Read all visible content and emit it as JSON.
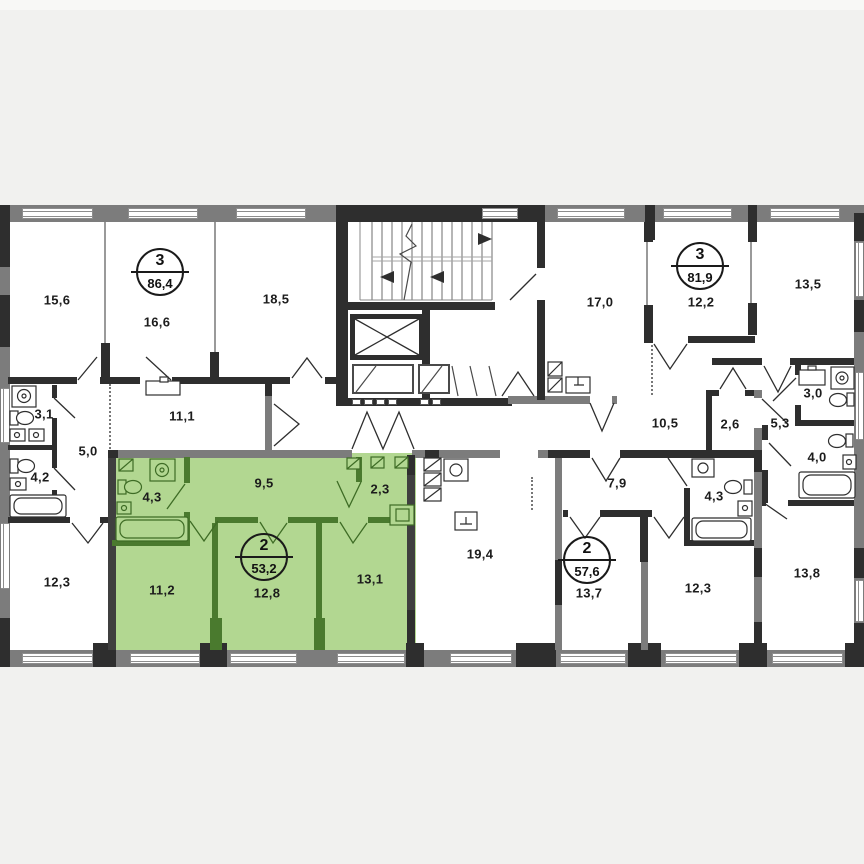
{
  "plan": {
    "type": "apartment-floor-plan",
    "highlight_color": "#b2d791",
    "highlight_wall_color": "#4a7a2e",
    "wall_color": "#2e2e2e",
    "outer_wall_color": "#7c7c7c"
  },
  "apartments": [
    {
      "rooms": "3",
      "area": "86,4",
      "highlighted": false
    },
    {
      "rooms": "3",
      "area": "81,9",
      "highlighted": false
    },
    {
      "rooms": "2",
      "area": "53,2",
      "highlighted": true
    },
    {
      "rooms": "2",
      "area": "57,6",
      "highlighted": false
    }
  ],
  "rooms": [
    {
      "area": "15,6"
    },
    {
      "area": "16,6"
    },
    {
      "area": "18,5"
    },
    {
      "area": "3,1"
    },
    {
      "area": "11,1"
    },
    {
      "area": "5,0"
    },
    {
      "area": "4,2"
    },
    {
      "area": "12,3"
    },
    {
      "area": "4,3"
    },
    {
      "area": "9,5"
    },
    {
      "area": "2,3"
    },
    {
      "area": "11,2"
    },
    {
      "area": "12,8"
    },
    {
      "area": "13,1"
    },
    {
      "area": "19,4"
    },
    {
      "area": "7,9"
    },
    {
      "area": "4,3"
    },
    {
      "area": "13,7"
    },
    {
      "area": "12,3"
    },
    {
      "area": "13,8"
    },
    {
      "area": "17,0"
    },
    {
      "area": "12,2"
    },
    {
      "area": "13,5"
    },
    {
      "area": "10,5"
    },
    {
      "area": "2,6"
    },
    {
      "area": "5,3"
    },
    {
      "area": "3,0"
    },
    {
      "area": "4,0"
    }
  ]
}
